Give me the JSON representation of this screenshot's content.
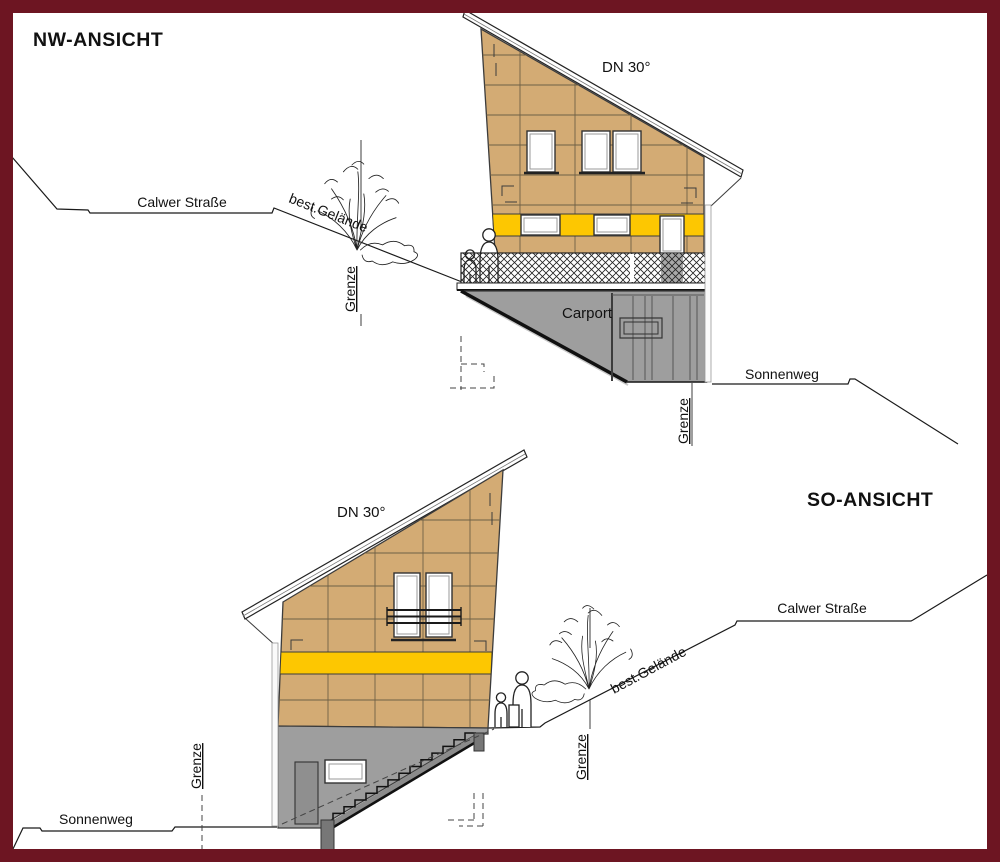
{
  "colors": {
    "border": "#6d1522",
    "facade": "#d3ab74",
    "band": "#fdc701",
    "base": "#9e9e9e",
    "base_dark": "#8f8f8f",
    "grid": "#6e6046"
  },
  "upper": {
    "title": "NW-ANSICHT",
    "roof_pitch": "DN 30°",
    "street_top": "Calwer Straße",
    "terrain_label": "best.Gelände",
    "boundary_left": "Grenze",
    "boundary_right": "Grenze",
    "carport_label": "Carport",
    "street_bottom": "Sonnenweg"
  },
  "lower": {
    "title": "SO-ANSICHT",
    "roof_pitch": "DN 30°",
    "street_top": "Calwer Straße",
    "terrain_label": "best.Gelände",
    "boundary_mid": "Grenze",
    "boundary_street": "Grenze",
    "street_bottom": "Sonnenweg"
  }
}
